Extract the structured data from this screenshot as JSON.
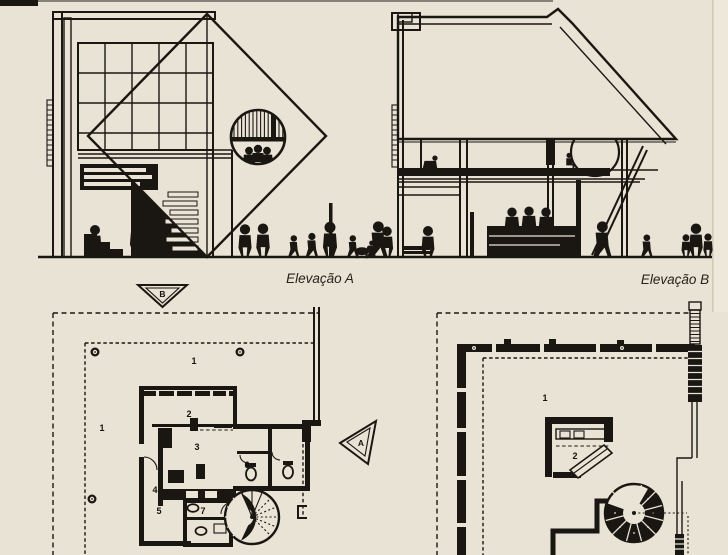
{
  "palette": {
    "paper": "#e8e3d4",
    "ink": "#1a1713"
  },
  "elevations": {
    "a_caption": "Elevação A",
    "b_caption": "Elevação B"
  },
  "markers": {
    "section_b": "B",
    "section_a": "A"
  },
  "plan_left": {
    "zone_top": "1",
    "zone_left": "1",
    "room_2": "2",
    "room_3": "3",
    "room_4": "4",
    "room_5": "5",
    "room_6": "6",
    "room_7": "7"
  },
  "plan_right": {
    "zone_main": "1",
    "room_2": "2"
  }
}
